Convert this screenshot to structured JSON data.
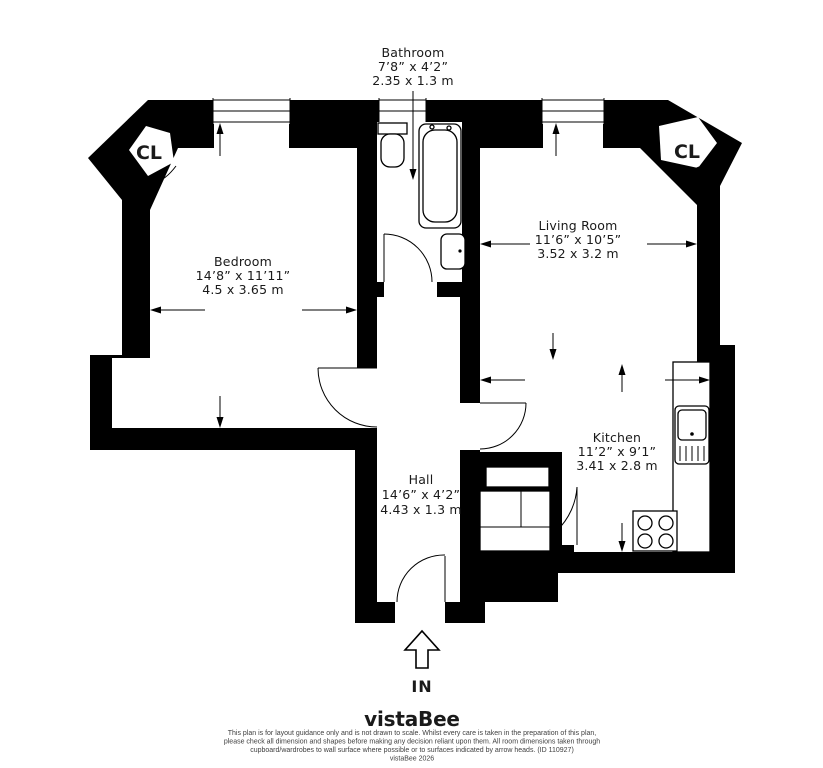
{
  "plan": {
    "rooms": {
      "bathroom": {
        "name": "Bathroom",
        "dims_imperial": "7’8” x 4’2”",
        "dims_metric": "2.35 x 1.3 m"
      },
      "bedroom": {
        "name": "Bedroom",
        "dims_imperial": "14’8” x 11’11”",
        "dims_metric": "4.5 x 3.65 m"
      },
      "living_room": {
        "name": "Living Room",
        "dims_imperial": "11’6” x 10’5”",
        "dims_metric": "3.52 x 3.2 m"
      },
      "kitchen": {
        "name": "Kitchen",
        "dims_imperial": "11’2” x 9’1”",
        "dims_metric": "3.41 x 2.8 m"
      },
      "hall": {
        "name": "Hall",
        "dims_imperial": "14’6” x 4’2”",
        "dims_metric": "4.43 x 1.3 m"
      }
    },
    "closet_label_left": "CL",
    "closet_label_right": "CL",
    "entrance_label": "IN"
  },
  "footer": {
    "brand": "vistaBee",
    "brand_color": "#1b4a42",
    "disclaimer_lines": [
      "This plan is for layout guidance only and is not drawn to scale. Whilst every care is taken in the preparation of this plan,",
      "please check all dimension and shapes before making any decision reliant upon them. All room dimensions taken through",
      "cupboard/wardrobes to wall surface where possible or to surfaces indicated by arrow heads. (ID 110927)",
      "vistaBee 2026"
    ]
  },
  "colors": {
    "walls": "#000000",
    "background": "#ffffff",
    "label_text": "#1a1a1a"
  }
}
